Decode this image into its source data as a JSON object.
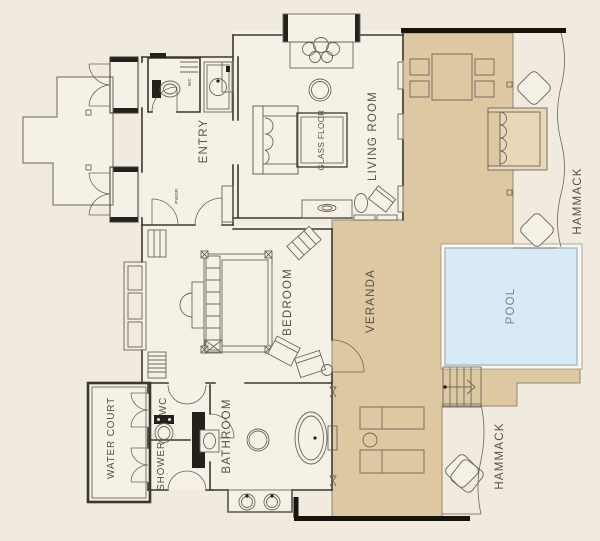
{
  "labels": {
    "entry": "ENTRY",
    "living_room": "LIVING ROOM",
    "glass_floor": "GLASS FLOOR",
    "bedroom": "BEDROOM",
    "veranda": "VERANDA",
    "pool": "POOL",
    "bathroom": "BATHROOM",
    "shower": "SHOWER",
    "wc": "WC",
    "wc_small": "WC",
    "powder": "PWDR",
    "water_court": "WATER COURT",
    "hammack_upper": "HAMMACK",
    "hammack_lower": "HAMMACK"
  },
  "colors": {
    "background": "#f1ebdf",
    "room_fill": "#f6f1e6",
    "deck": "#ddc8a2",
    "deck_soft": "#e8d8b8",
    "pool_fill": "#d9eaf7",
    "pool_edge": "#9fb0bc",
    "wall": "#3b382f",
    "wall_heavy": "#17140f",
    "line": "#6b665a",
    "dark": "#23211c",
    "label": "#55514a",
    "label_pool": "#74838f",
    "deck_edge": "#8f8778"
  }
}
